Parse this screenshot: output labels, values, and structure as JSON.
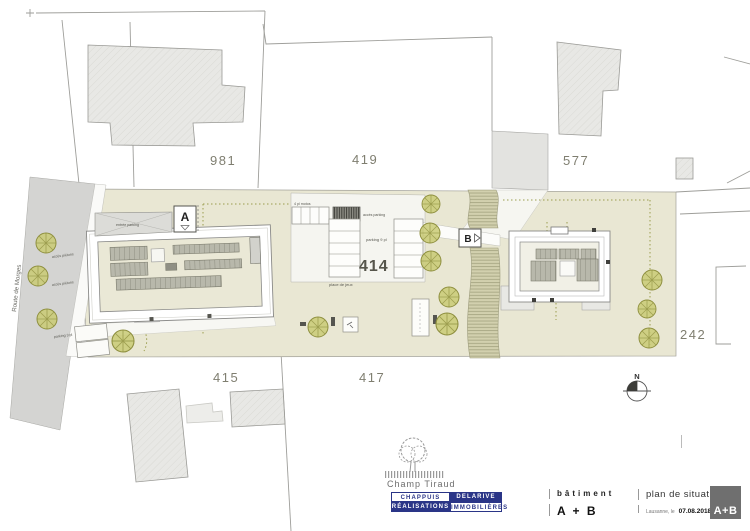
{
  "colors": {
    "site_beige": "#e9e7d3",
    "road_gray": "#d4d4d2",
    "building_gray": "#e8e8e5",
    "panel_gray": "#b8b8ab",
    "tree_olive": "#c9ca74",
    "slope_olive": "#d2d0ae",
    "brand_navy": "#2a3587",
    "sheet_gray": "#6f6f6f",
    "line_gray": "#9e9e9a"
  },
  "plan": {
    "road_name": "Route de Morges",
    "parcels": {
      "p981": "981",
      "p419": "419",
      "p577": "577",
      "p414": "414",
      "p415": "415",
      "p417": "417",
      "p242": "242"
    },
    "buildings": {
      "a": "A",
      "b": "B"
    },
    "labels": {
      "entree_parking": "entrée parking",
      "acces_pietons_a": "accès piétons",
      "acces_pietons_b": "accès piétons",
      "parking_3": "parking 3 pl",
      "motos": "4 pl motos",
      "acces_parking": "accès parking",
      "parking_9": "parking 9 pl",
      "place_de_jeux": "place de jeux"
    },
    "north": "N"
  },
  "titleblock": {
    "project": "Champ Tiraud",
    "company": {
      "c1": "CHAPPUIS",
      "c2": "DELARIVE",
      "c3": "RÉALISATIONS",
      "c4": "IMMOBILIÈRES"
    },
    "batiment_label": "bâtiment",
    "batiment_value": "A + B",
    "doc_title": "plan de situation",
    "place_label": "Lausanne, le",
    "date": "07.08.2018",
    "sheet": "A+B"
  }
}
